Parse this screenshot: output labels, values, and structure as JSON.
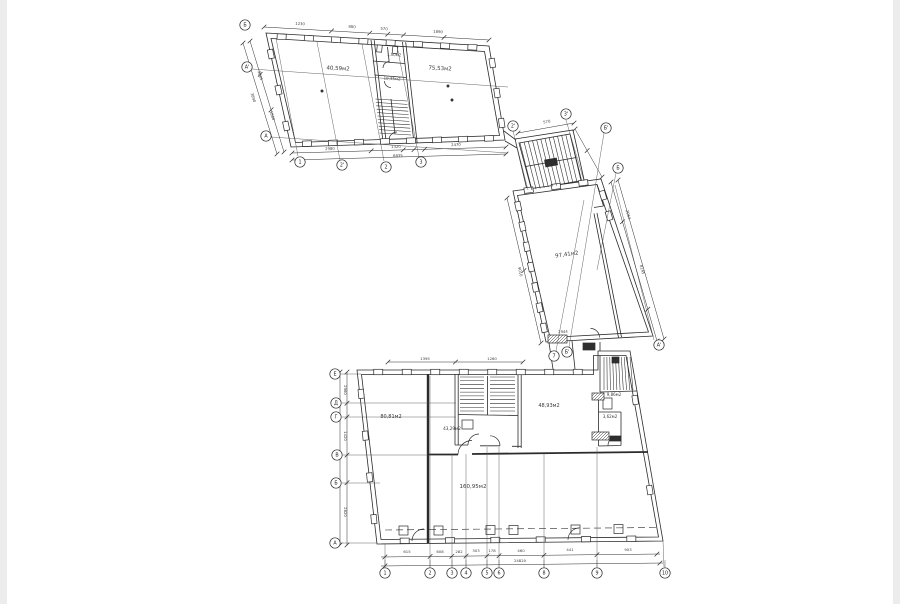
{
  "drawing": {
    "type": "architectural-floor-plan",
    "line_color": "#2b2b2b",
    "rooms": [
      {
        "label": "40,59м2",
        "x": 338,
        "y": 70,
        "r": 3,
        "fs": 5.5
      },
      {
        "label": "1,50м2",
        "x": 394,
        "y": 56,
        "r": 3,
        "fs": 4
      },
      {
        "label": "10,35м2",
        "x": 392,
        "y": 80,
        "r": 3,
        "fs": 4
      },
      {
        "label": "75,53м2",
        "x": 440,
        "y": 70,
        "r": 3,
        "fs": 5.5
      },
      {
        "label": "97,41м2",
        "x": 567,
        "y": 256,
        "r": -8,
        "fs": 5.5
      },
      {
        "label": "80,81м2",
        "x": 391,
        "y": 418,
        "r": 0,
        "fs": 5
      },
      {
        "label": "43,29м2",
        "x": 452,
        "y": 430,
        "r": 0,
        "fs": 4.2
      },
      {
        "label": "48,93м2",
        "x": 549,
        "y": 407,
        "r": 0,
        "fs": 5
      },
      {
        "label": "9,86м2",
        "x": 614,
        "y": 396,
        "r": 0,
        "fs": 4
      },
      {
        "label": "3,62м2",
        "x": 610,
        "y": 418,
        "r": 0,
        "fs": 4
      },
      {
        "label": "160,95м2",
        "x": 473,
        "y": 488,
        "r": 0,
        "fs": 5.5
      }
    ],
    "bubbles": [
      {
        "label": "Б",
        "x": 245,
        "y": 25
      },
      {
        "label": "А'",
        "x": 247,
        "y": 67
      },
      {
        "label": "А",
        "x": 266,
        "y": 136
      },
      {
        "label": "1",
        "x": 300,
        "y": 162
      },
      {
        "label": "2'",
        "x": 342,
        "y": 165
      },
      {
        "label": "2",
        "x": 386,
        "y": 167
      },
      {
        "label": "3",
        "x": 421,
        "y": 162
      },
      {
        "label": "2'",
        "x": 513,
        "y": 126
      },
      {
        "label": "3'",
        "x": 566,
        "y": 114
      },
      {
        "label": "Б'",
        "x": 606,
        "y": 128
      },
      {
        "label": "Б",
        "x": 618,
        "y": 168
      },
      {
        "label": "7",
        "x": 554,
        "y": 356
      },
      {
        "label": "Б'",
        "x": 567,
        "y": 352
      },
      {
        "label": "А'",
        "x": 659,
        "y": 345
      },
      {
        "label": "Е",
        "x": 335,
        "y": 374
      },
      {
        "label": "Д",
        "x": 336,
        "y": 403
      },
      {
        "label": "Г",
        "x": 336,
        "y": 417
      },
      {
        "label": "В",
        "x": 337,
        "y": 455
      },
      {
        "label": "Б",
        "x": 336,
        "y": 483
      },
      {
        "label": "А",
        "x": 335,
        "y": 543
      },
      {
        "label": "1",
        "x": 385,
        "y": 573
      },
      {
        "label": "2",
        "x": 430,
        "y": 573
      },
      {
        "label": "3",
        "x": 452,
        "y": 573
      },
      {
        "label": "4",
        "x": 466,
        "y": 573
      },
      {
        "label": "5",
        "x": 487,
        "y": 573
      },
      {
        "label": "6",
        "x": 499,
        "y": 573
      },
      {
        "label": "8",
        "x": 544,
        "y": 573
      },
      {
        "label": "9",
        "x": 597,
        "y": 573
      },
      {
        "label": "10",
        "x": 665,
        "y": 573
      }
    ],
    "dims": [
      {
        "label": "1230",
        "x": 300,
        "y": 25,
        "r": 3
      },
      {
        "label": "880",
        "x": 352,
        "y": 28,
        "r": 3
      },
      {
        "label": "570",
        "x": 384,
        "y": 30,
        "r": 3
      },
      {
        "label": "1890",
        "x": 438,
        "y": 33,
        "r": 3
      },
      {
        "label": "2980",
        "x": 330,
        "y": 150,
        "r": -2
      },
      {
        "label": "1320",
        "x": 396,
        "y": 148,
        "r": -2
      },
      {
        "label": "2470",
        "x": 456,
        "y": 146,
        "r": -2
      },
      {
        "label": "6835",
        "x": 398,
        "y": 157,
        "r": -2
      },
      {
        "label": "2005",
        "x": 259,
        "y": 76,
        "r": 73
      },
      {
        "label": "1860",
        "x": 271,
        "y": 116,
        "r": 73
      },
      {
        "label": "3890",
        "x": 252,
        "y": 98,
        "r": 73
      },
      {
        "label": "570",
        "x": 547,
        "y": 123,
        "r": -10
      },
      {
        "label": "2064",
        "x": 627,
        "y": 215,
        "r": 74
      },
      {
        "label": "8145",
        "x": 641,
        "y": 270,
        "r": 74
      },
      {
        "label": "9010",
        "x": 519,
        "y": 272,
        "r": 77
      },
      {
        "label": "2944",
        "x": 563,
        "y": 333,
        "r": -2
      },
      {
        "label": "615",
        "x": 407,
        "y": 553,
        "r": 0
      },
      {
        "label": "608",
        "x": 440,
        "y": 553,
        "r": 0
      },
      {
        "label": "282",
        "x": 459,
        "y": 553,
        "r": 0
      },
      {
        "label": "303",
        "x": 476,
        "y": 552,
        "r": 0
      },
      {
        "label": "178",
        "x": 492,
        "y": 552,
        "r": 0
      },
      {
        "label": "460",
        "x": 521,
        "y": 552,
        "r": 0
      },
      {
        "label": "441",
        "x": 570,
        "y": 551,
        "r": 0
      },
      {
        "label": "903",
        "x": 628,
        "y": 551,
        "r": 0
      },
      {
        "label": "24820",
        "x": 520,
        "y": 562,
        "r": 0
      },
      {
        "label": "2980",
        "x": 344,
        "y": 390,
        "r": 90
      },
      {
        "label": "1420",
        "x": 344,
        "y": 436,
        "r": 90
      },
      {
        "label": "2820",
        "x": 344,
        "y": 512,
        "r": 90
      },
      {
        "label": "1395",
        "x": 425,
        "y": 360,
        "r": 0
      },
      {
        "label": "1260",
        "x": 492,
        "y": 360,
        "r": 0
      }
    ]
  }
}
